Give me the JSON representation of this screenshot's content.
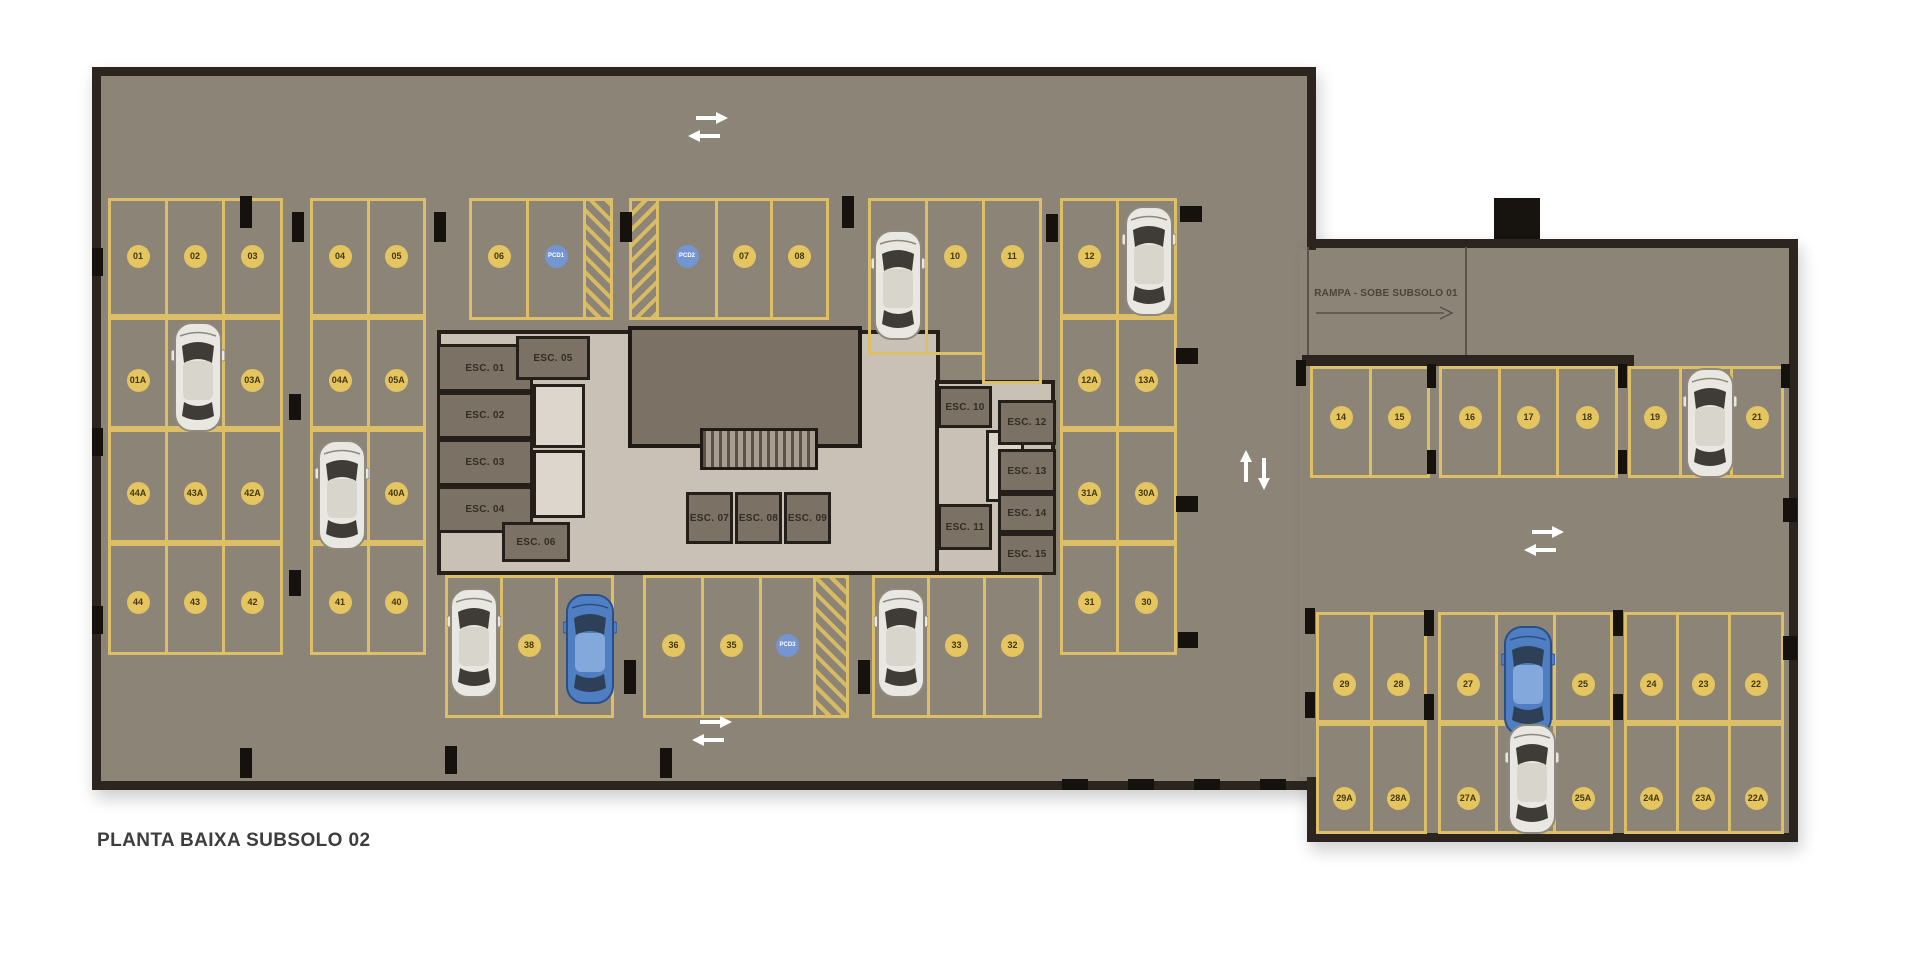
{
  "title": "PLANTA BAIXA SUBSOLO 02",
  "ramp_label": "RAMPA - SOBE SUBSOLO 01",
  "colors": {
    "floor": "#8d8478",
    "wall": "#2b241f",
    "stall_line": "#ddbf68",
    "spot_badge": "#e5c560",
    "spot_badge_text": "#42370f",
    "pcd_badge": "#7396d2",
    "pcd_badge_text": "#ffffff",
    "car_white": "#e9e7e2",
    "car_blue": "#4f7ec2",
    "arrow": "#ffffff",
    "title_text": "#3d3d3d"
  },
  "structure": {
    "main_hall": {
      "x": 92,
      "y": 67,
      "w": 1224,
      "h": 723
    },
    "wing": {
      "x": 1307,
      "y": 239,
      "w": 491,
      "h": 603
    },
    "junction_patch": {
      "x": 1300,
      "y": 250,
      "w": 24,
      "h": 527
    },
    "chimney": {
      "x": 1494,
      "y": 198,
      "w": 46,
      "h": 49
    },
    "ramp_box": {
      "x": 1307,
      "y": 247,
      "w": 160,
      "h": 115
    },
    "wing_wall_bar": {
      "x": 1302,
      "y": 355,
      "w": 332,
      "h": 11
    }
  },
  "parking_blocks": [
    {
      "x": 108,
      "y": 198,
      "h": 119,
      "dy": 58,
      "cells": [
        {
          "l": "01",
          "w": 60
        },
        {
          "l": "02",
          "w": 60
        },
        {
          "l": "03",
          "w": 61
        }
      ]
    },
    {
      "x": 310,
      "y": 198,
      "h": 119,
      "dy": 58,
      "cells": [
        {
          "l": "04",
          "w": 60
        },
        {
          "l": "05",
          "w": 59
        }
      ]
    },
    {
      "x": 469,
      "y": 198,
      "h": 122,
      "dy": 58,
      "cells": [
        {
          "l": "06",
          "w": 60
        },
        {
          "l": "PCD1",
          "w": 60
        },
        {
          "l": "#",
          "w": 30,
          "dir": 45
        }
      ]
    },
    {
      "x": 629,
      "y": 198,
      "h": 122,
      "dy": 58,
      "cells": [
        {
          "l": "#",
          "w": 30,
          "dir": 135
        },
        {
          "l": "PCD2",
          "w": 62
        },
        {
          "l": "07",
          "w": 58
        },
        {
          "l": "08",
          "w": 59
        }
      ]
    },
    {
      "x": 868,
      "y": 198,
      "h": 157,
      "dy": 58,
      "cells": [
        {
          "l": "09",
          "w": 60
        },
        {
          "l": "10",
          "w": 60
        },
        {
          "l": "11",
          "w": 60,
          "h": 186
        }
      ]
    },
    {
      "x": 1060,
      "y": 198,
      "h": 119,
      "dy": 58,
      "cells": [
        {
          "l": "12",
          "w": 59
        },
        {
          "l": "13",
          "w": 61
        }
      ]
    },
    {
      "x": 108,
      "y": 317,
      "h": 112,
      "dy": 63,
      "cells": [
        {
          "l": "01A",
          "w": 60
        },
        {
          "l": "02A",
          "w": 60
        },
        {
          "l": "03A",
          "w": 61
        }
      ]
    },
    {
      "x": 310,
      "y": 317,
      "h": 112,
      "dy": 63,
      "cells": [
        {
          "l": "04A",
          "w": 60
        },
        {
          "l": "05A",
          "w": 59
        }
      ]
    },
    {
      "x": 1060,
      "y": 317,
      "h": 112,
      "dy": 63,
      "cells": [
        {
          "l": "12A",
          "w": 59
        },
        {
          "l": "13A",
          "w": 61
        }
      ]
    },
    {
      "x": 108,
      "y": 429,
      "h": 114,
      "dy": 64,
      "cells": [
        {
          "l": "44A",
          "w": 60
        },
        {
          "l": "43A",
          "w": 60
        },
        {
          "l": "42A",
          "w": 61
        }
      ]
    },
    {
      "x": 310,
      "y": 429,
      "h": 114,
      "dy": 64,
      "cells": [
        {
          "l": "41A",
          "w": 60
        },
        {
          "l": "40A",
          "w": 59
        }
      ]
    },
    {
      "x": 1060,
      "y": 429,
      "h": 114,
      "dy": 64,
      "cells": [
        {
          "l": "31A",
          "w": 59
        },
        {
          "l": "30A",
          "w": 61
        }
      ]
    },
    {
      "x": 108,
      "y": 543,
      "h": 112,
      "dy": 59,
      "cells": [
        {
          "l": "44",
          "w": 60
        },
        {
          "l": "43",
          "w": 60
        },
        {
          "l": "42",
          "w": 61
        }
      ]
    },
    {
      "x": 310,
      "y": 543,
      "h": 112,
      "dy": 59,
      "cells": [
        {
          "l": "41",
          "w": 60
        },
        {
          "l": "40",
          "w": 59
        }
      ]
    },
    {
      "x": 1060,
      "y": 543,
      "h": 112,
      "dy": 59,
      "cells": [
        {
          "l": "31",
          "w": 59
        },
        {
          "l": "30",
          "w": 61
        }
      ]
    },
    {
      "x": 445,
      "y": 575,
      "h": 143,
      "dy": 70,
      "cells": [
        {
          "l": "39",
          "w": 58
        },
        {
          "l": "38",
          "w": 58
        },
        {
          "l": "37",
          "w": 59
        }
      ]
    },
    {
      "x": 643,
      "y": 575,
      "h": 143,
      "dy": 70,
      "cells": [
        {
          "l": "36",
          "w": 61
        },
        {
          "l": "35",
          "w": 61
        },
        {
          "l": "PCD3",
          "w": 57
        },
        {
          "l": "#",
          "w": 36,
          "dir": 45
        }
      ]
    },
    {
      "x": 872,
      "y": 575,
      "h": 143,
      "dy": 70,
      "cells": [
        {
          "l": "34",
          "w": 58
        },
        {
          "l": "33",
          "w": 59
        },
        {
          "l": "32",
          "w": 59
        }
      ]
    },
    {
      "x": 1310,
      "y": 366,
      "h": 112,
      "dy": 51,
      "cells": [
        {
          "l": "14",
          "w": 62
        },
        {
          "l": "15",
          "w": 61
        }
      ]
    },
    {
      "x": 1439,
      "y": 366,
      "h": 112,
      "dy": 51,
      "cells": [
        {
          "l": "16",
          "w": 62
        },
        {
          "l": "17",
          "w": 61
        },
        {
          "l": "18",
          "w": 62
        }
      ]
    },
    {
      "x": 1628,
      "y": 366,
      "h": 112,
      "dy": 51,
      "cells": [
        {
          "l": "19",
          "w": 54
        },
        {
          "l": "20",
          "w": 54
        },
        {
          "l": "21",
          "w": 54
        }
      ]
    },
    {
      "x": 1316,
      "y": 612,
      "h": 111,
      "dy": 72,
      "cells": [
        {
          "l": "29",
          "w": 57
        },
        {
          "l": "28",
          "w": 57
        }
      ]
    },
    {
      "x": 1438,
      "y": 612,
      "h": 111,
      "dy": 72,
      "cells": [
        {
          "l": "27",
          "w": 60
        },
        {
          "l": "26",
          "w": 61
        },
        {
          "l": "25",
          "w": 60
        }
      ]
    },
    {
      "x": 1624,
      "y": 612,
      "h": 111,
      "dy": 72,
      "cells": [
        {
          "l": "24",
          "w": 55
        },
        {
          "l": "23",
          "w": 55
        },
        {
          "l": "22",
          "w": 56
        }
      ]
    },
    {
      "x": 1316,
      "y": 723,
      "h": 111,
      "dy": 75,
      "cells": [
        {
          "l": "29A",
          "w": 57
        },
        {
          "l": "28A",
          "w": 57
        }
      ]
    },
    {
      "x": 1438,
      "y": 723,
      "h": 111,
      "dy": 75,
      "cells": [
        {
          "l": "27A",
          "w": 60
        },
        {
          "l": "26A",
          "w": 61
        },
        {
          "l": "25A",
          "w": 60
        }
      ]
    },
    {
      "x": 1624,
      "y": 723,
      "h": 111,
      "dy": 75,
      "cells": [
        {
          "l": "24A",
          "w": 55
        },
        {
          "l": "23A",
          "w": 55
        },
        {
          "l": "22A",
          "w": 56
        }
      ]
    }
  ],
  "core": {
    "bases": [
      {
        "x": 437,
        "y": 330,
        "w": 503,
        "h": 245
      },
      {
        "x": 935,
        "y": 380,
        "w": 120,
        "h": 195
      }
    ],
    "dark_block": {
      "x": 628,
      "y": 326,
      "w": 234,
      "h": 122
    },
    "stairs": {
      "x": 700,
      "y": 428,
      "w": 118,
      "h": 42
    },
    "shafts": [
      {
        "x": 533,
        "y": 384,
        "w": 52,
        "h": 64
      },
      {
        "x": 533,
        "y": 450,
        "w": 52,
        "h": 68
      },
      {
        "x": 986,
        "y": 430,
        "w": 38,
        "h": 72
      }
    ],
    "rooms": [
      {
        "label": "ESC. 01",
        "x": 437,
        "y": 344,
        "w": 96,
        "h": 48
      },
      {
        "label": "ESC. 02",
        "x": 437,
        "y": 392,
        "w": 96,
        "h": 47
      },
      {
        "label": "ESC. 03",
        "x": 437,
        "y": 439,
        "w": 96,
        "h": 47
      },
      {
        "label": "ESC. 04",
        "x": 437,
        "y": 486,
        "w": 96,
        "h": 47
      },
      {
        "label": "ESC. 05",
        "x": 516,
        "y": 336,
        "w": 74,
        "h": 44
      },
      {
        "label": "ESC. 06",
        "x": 502,
        "y": 522,
        "w": 68,
        "h": 40
      },
      {
        "label": "ESC. 07",
        "x": 686,
        "y": 492,
        "w": 47,
        "h": 52
      },
      {
        "label": "ESC. 08",
        "x": 735,
        "y": 492,
        "w": 47,
        "h": 52
      },
      {
        "label": "ESC. 09",
        "x": 784,
        "y": 492,
        "w": 47,
        "h": 52
      },
      {
        "label": "ESC. 10",
        "x": 938,
        "y": 386,
        "w": 54,
        "h": 42
      },
      {
        "label": "ESC. 11",
        "x": 938,
        "y": 504,
        "w": 54,
        "h": 46
      },
      {
        "label": "ESC. 12",
        "x": 998,
        "y": 400,
        "w": 58,
        "h": 45
      },
      {
        "label": "ESC. 13",
        "x": 998,
        "y": 449,
        "w": 58,
        "h": 44
      },
      {
        "label": "ESC. 14",
        "x": 998,
        "y": 493,
        "w": 58,
        "h": 40
      },
      {
        "label": "ESC. 15",
        "x": 998,
        "y": 533,
        "w": 58,
        "h": 42
      }
    ]
  },
  "cars": [
    {
      "x": 198,
      "y": 318,
      "c": "white"
    },
    {
      "x": 342,
      "y": 436,
      "c": "white"
    },
    {
      "x": 898,
      "y": 226,
      "c": "white"
    },
    {
      "x": 1149,
      "y": 202,
      "c": "white"
    },
    {
      "x": 474,
      "y": 584,
      "c": "white"
    },
    {
      "x": 590,
      "y": 590,
      "c": "blue"
    },
    {
      "x": 901,
      "y": 584,
      "c": "white"
    },
    {
      "x": 1710,
      "y": 364,
      "c": "white"
    },
    {
      "x": 1528,
      "y": 622,
      "c": "blue"
    },
    {
      "x": 1532,
      "y": 720,
      "c": "white"
    }
  ],
  "arrows": [
    {
      "type": "h-pair",
      "x": 688,
      "y": 112
    },
    {
      "type": "h-pair",
      "x": 692,
      "y": 716
    },
    {
      "type": "v-pair",
      "x": 1240,
      "y": 450
    },
    {
      "type": "h-pair",
      "x": 1524,
      "y": 526
    }
  ],
  "pillars": [
    [
      240,
      196,
      12,
      32
    ],
    [
      292,
      212,
      12,
      30
    ],
    [
      434,
      212,
      12,
      30
    ],
    [
      620,
      212,
      12,
      30
    ],
    [
      842,
      196,
      12,
      32
    ],
    [
      1046,
      214,
      12,
      28
    ],
    [
      1180,
      206,
      22,
      16
    ],
    [
      1176,
      348,
      22,
      16
    ],
    [
      1176,
      496,
      22,
      16
    ],
    [
      1178,
      632,
      20,
      16
    ],
    [
      92,
      248,
      11,
      28
    ],
    [
      92,
      428,
      11,
      28
    ],
    [
      92,
      606,
      11,
      28
    ],
    [
      289,
      394,
      12,
      26
    ],
    [
      289,
      570,
      12,
      26
    ],
    [
      624,
      660,
      12,
      34
    ],
    [
      858,
      660,
      12,
      34
    ],
    [
      240,
      748,
      12,
      30
    ],
    [
      445,
      746,
      12,
      28
    ],
    [
      660,
      748,
      12,
      30
    ],
    [
      1062,
      779,
      26,
      11
    ],
    [
      1128,
      779,
      26,
      11
    ],
    [
      1194,
      779,
      26,
      11
    ],
    [
      1260,
      779,
      26,
      11
    ],
    [
      1296,
      360,
      10,
      26
    ],
    [
      1427,
      364,
      9,
      24
    ],
    [
      1618,
      364,
      9,
      24
    ],
    [
      1781,
      364,
      9,
      24
    ],
    [
      1427,
      450,
      9,
      24
    ],
    [
      1618,
      450,
      9,
      24
    ],
    [
      1783,
      498,
      14,
      24
    ],
    [
      1783,
      636,
      14,
      24
    ],
    [
      1305,
      608,
      10,
      26
    ],
    [
      1424,
      610,
      10,
      26
    ],
    [
      1613,
      610,
      10,
      26
    ],
    [
      1305,
      692,
      10,
      26
    ],
    [
      1424,
      694,
      10,
      26
    ],
    [
      1613,
      694,
      10,
      26
    ]
  ]
}
